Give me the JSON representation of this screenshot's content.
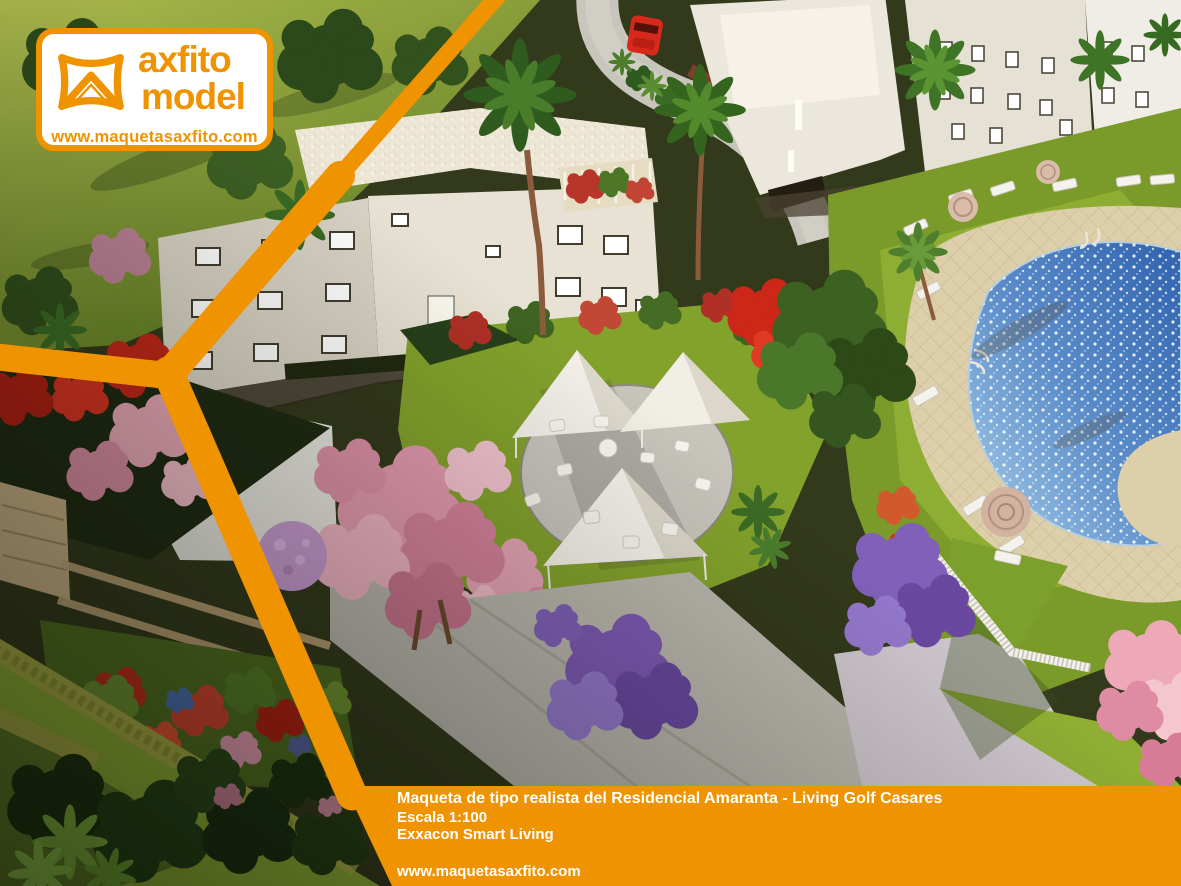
{
  "brand_badge": {
    "word_top": "axfito",
    "word_bottom": "model",
    "website": "www.maquetasaxfito.com"
  },
  "caption_bar": {
    "line1": "Maqueta de tipo realista del Residencial Amaranta - Living Golf Casares",
    "line2": "Escala 1:100",
    "line3": "Exxacon Smart Living",
    "website": "www.maquetasaxfito.com"
  },
  "colors": {
    "brand_orange": "#F09301",
    "caption_text": "#FFFFFF",
    "badge_background": "#FFFFFF",
    "pool_blue": "#5B8CC9",
    "lawn_green": "#8FAE2F"
  },
  "scene": {
    "type": "aerial-photo-architectural-scale-model",
    "elements": [
      "white-apartment-buildings-with-lit-windows",
      "palm-trees",
      "red-car-on-curved-road",
      "swimming-pool-with-tiled-deck",
      "sun-loungers-and-parasols",
      "chill-out-circle-with-three-white-canopy-tents-and-sofas",
      "pink-flowering-trees",
      "purple-flowering-trees",
      "flower-beds-and-hedges",
      "white-lattice-fence",
      "stone-retaining-walls"
    ]
  }
}
